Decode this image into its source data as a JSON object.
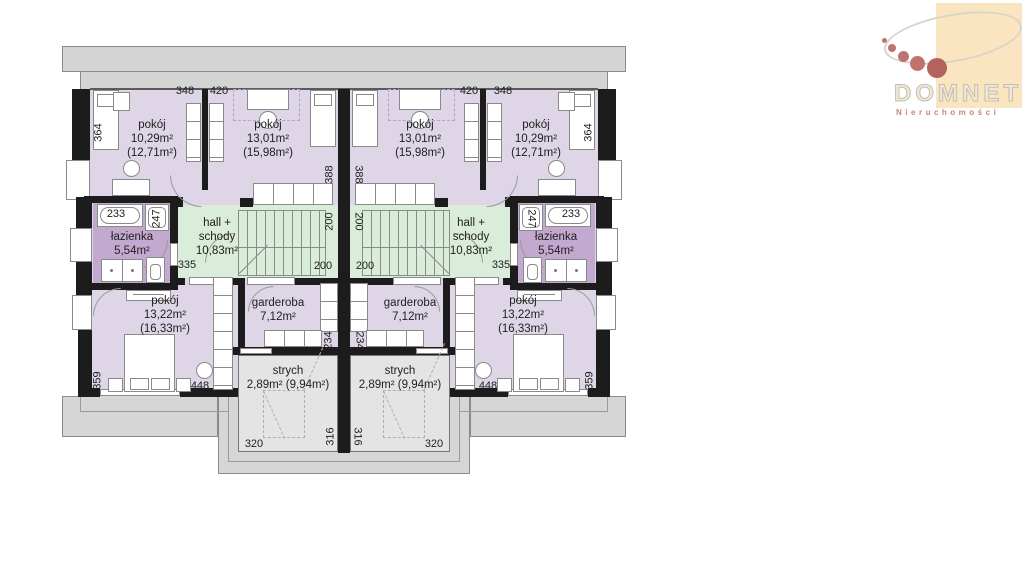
{
  "logo": {
    "brand": "DOMNET",
    "subtitle": "Nieruchomości",
    "colors": {
      "panel": "#fbe5c0",
      "dots": "#c0736e",
      "ellipse_outline": "#d9d5ca",
      "brand_text": "#efe9da",
      "subtitle_text": "#c98379"
    }
  },
  "plan": {
    "rooms": {
      "pokoj_small": {
        "name": "pokój",
        "area": "10,29m²",
        "area_floor": "(12,71m²)"
      },
      "pokoj_medium": {
        "name": "pokój",
        "area": "13,01m²",
        "area_floor": "(15,98m²)"
      },
      "hall": {
        "name_line1": "hall +",
        "name_line2": "schody",
        "area": "10,83m²"
      },
      "lazienka": {
        "name": "łazienka",
        "area": "5,54m²"
      },
      "pokoj_large": {
        "name": "pokój",
        "area": "13,22m²",
        "area_floor": "(16,33m²)"
      },
      "garderoba": {
        "name": "garderoba",
        "area": "7,12m²"
      },
      "strych": {
        "name": "strych",
        "area": "2,89m² (9,94m²)"
      }
    },
    "dimensions": {
      "d200": "200",
      "d233": "233",
      "d234": "234",
      "d247": "247",
      "d316": "316",
      "d320": "320",
      "d335": "335",
      "d348": "348",
      "d359": "359",
      "d364": "364",
      "d388": "388",
      "d420": "420",
      "d448": "448"
    },
    "colors": {
      "room_fill": "#ded5e7",
      "bathroom_fill": "#c3a8cf",
      "hall_fill": "#daecda",
      "attic_fill": "#e4e4e4",
      "roof_fill": "#d4d4d4",
      "wall": "#1c1c1c",
      "outline": "#8a8a8a"
    }
  }
}
